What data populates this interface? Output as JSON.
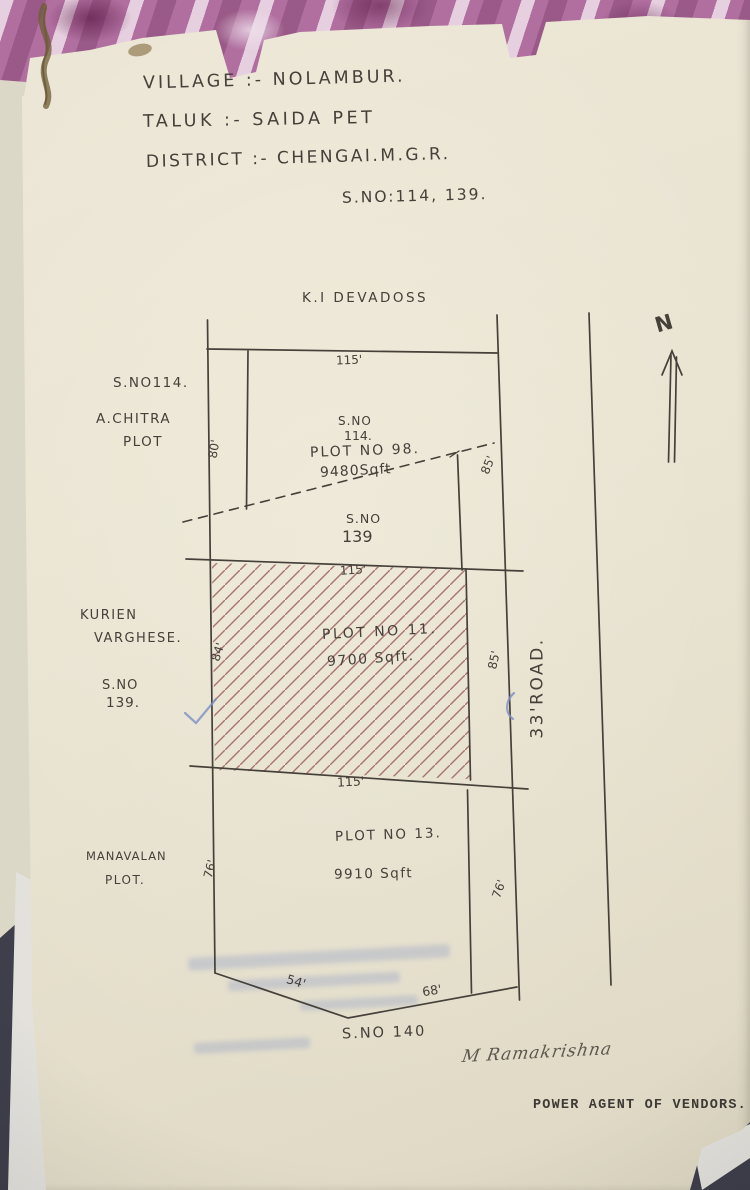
{
  "colors": {
    "table-bg": "#3e3f4b",
    "paper": "#e9e3d1",
    "paper-under": "#dcd8c8",
    "sheet-white": "#e2e1dc",
    "ink": "#45403a",
    "hatch": "#9c5f60",
    "fabric-base": "#b06f9f",
    "blue-mark": "#7d8fc3",
    "typed-ink": "#3e3a35",
    "thread": "#6e5c36"
  },
  "header": {
    "line1": "VILLAGE :-  NOLAMBUR.",
    "line2": "TALUK  :-  SAIDA PET",
    "line3": "DISTRICT :-  CHENGAI.M.G.R.",
    "line4": "S.NO:114, 139."
  },
  "plan": {
    "north_owner": "K.I DEVADOSS",
    "north_letter": "N",
    "road_label": "33'ROAD.",
    "side_left": {
      "sno114": "S.NO114.",
      "chitra_line1": "A.CHITRA",
      "chitra_line2": "PLOT",
      "kurien_line1": "KURIEN",
      "kurien_line2": "VARGHESE.",
      "sno139_line1": "S.NO",
      "sno139_line2": "139.",
      "manavalan_line1": "MANAVALAN",
      "manavalan_line2": "PLOT."
    },
    "plot98": {
      "sno_line1": "S.NO",
      "sno_line2": "114.",
      "title": "PLOT NO 98.",
      "area": "9480Sqft"
    },
    "sno139": {
      "line1": "S.NO",
      "line2": "139"
    },
    "plot11": {
      "title": "PLOT NO 11.",
      "area": "9700 Sqft."
    },
    "plot13": {
      "title": "PLOT NO 13.",
      "area": "9910 Sqft"
    },
    "sno140": "S.NO 140",
    "dims": {
      "top_115": "115'",
      "mid_115": "115'",
      "low_115": "115'",
      "left_80": "80'",
      "left_84": "84'",
      "left_76": "76'",
      "right_85_upper": "85'",
      "right_85_mid": "85'",
      "right_76": "76'",
      "bottom_54": "54'",
      "bottom_68": "68'"
    }
  },
  "footer": {
    "signature": "M Ramakrishna",
    "typed_title": "POWER AGENT OF VENDORS."
  }
}
